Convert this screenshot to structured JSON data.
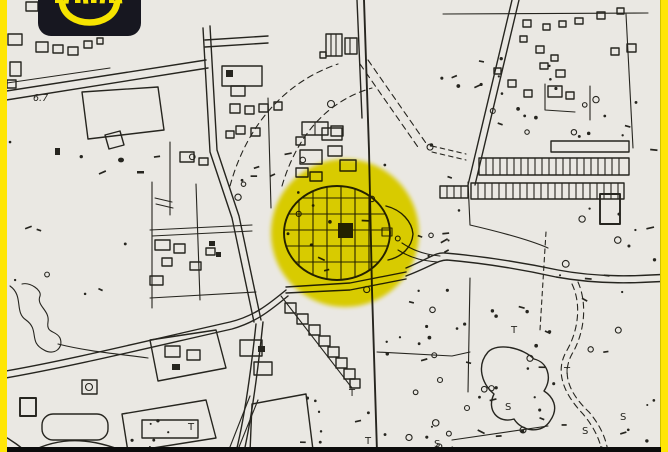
{
  "window": {
    "width": 668,
    "height": 452,
    "description": "scanned city map with highlighted old town"
  },
  "frame": {
    "side_border_color": "#ffe605",
    "bottom_bar_color": "#0c0c0c"
  },
  "logo": {
    "badge_color": "#171720",
    "accent_color": "#f6e400",
    "icon": "smile-icon",
    "text_cropped": true
  },
  "map": {
    "paper_color": "#eae8e3",
    "ink_color": "#26251f",
    "highlight_circle": {
      "color": "#ecdf00",
      "cx": 345,
      "cy": 233,
      "r": 74
    },
    "center_marker": "filled-square",
    "labels": [
      {
        "text": "6.7",
        "x": 33,
        "y": 101
      }
    ],
    "symbols": [
      {
        "text": "T",
        "x": 349,
        "y": 396
      },
      {
        "text": "T",
        "x": 365,
        "y": 444
      },
      {
        "text": "T",
        "x": 511,
        "y": 333
      },
      {
        "text": "T",
        "x": 564,
        "y": 374
      },
      {
        "text": "T",
        "x": 188,
        "y": 430
      },
      {
        "text": "S",
        "x": 505,
        "y": 410
      },
      {
        "text": "S",
        "x": 582,
        "y": 434
      },
      {
        "text": "S",
        "x": 620,
        "y": 420
      },
      {
        "text": "S",
        "x": 434,
        "y": 447
      }
    ]
  }
}
